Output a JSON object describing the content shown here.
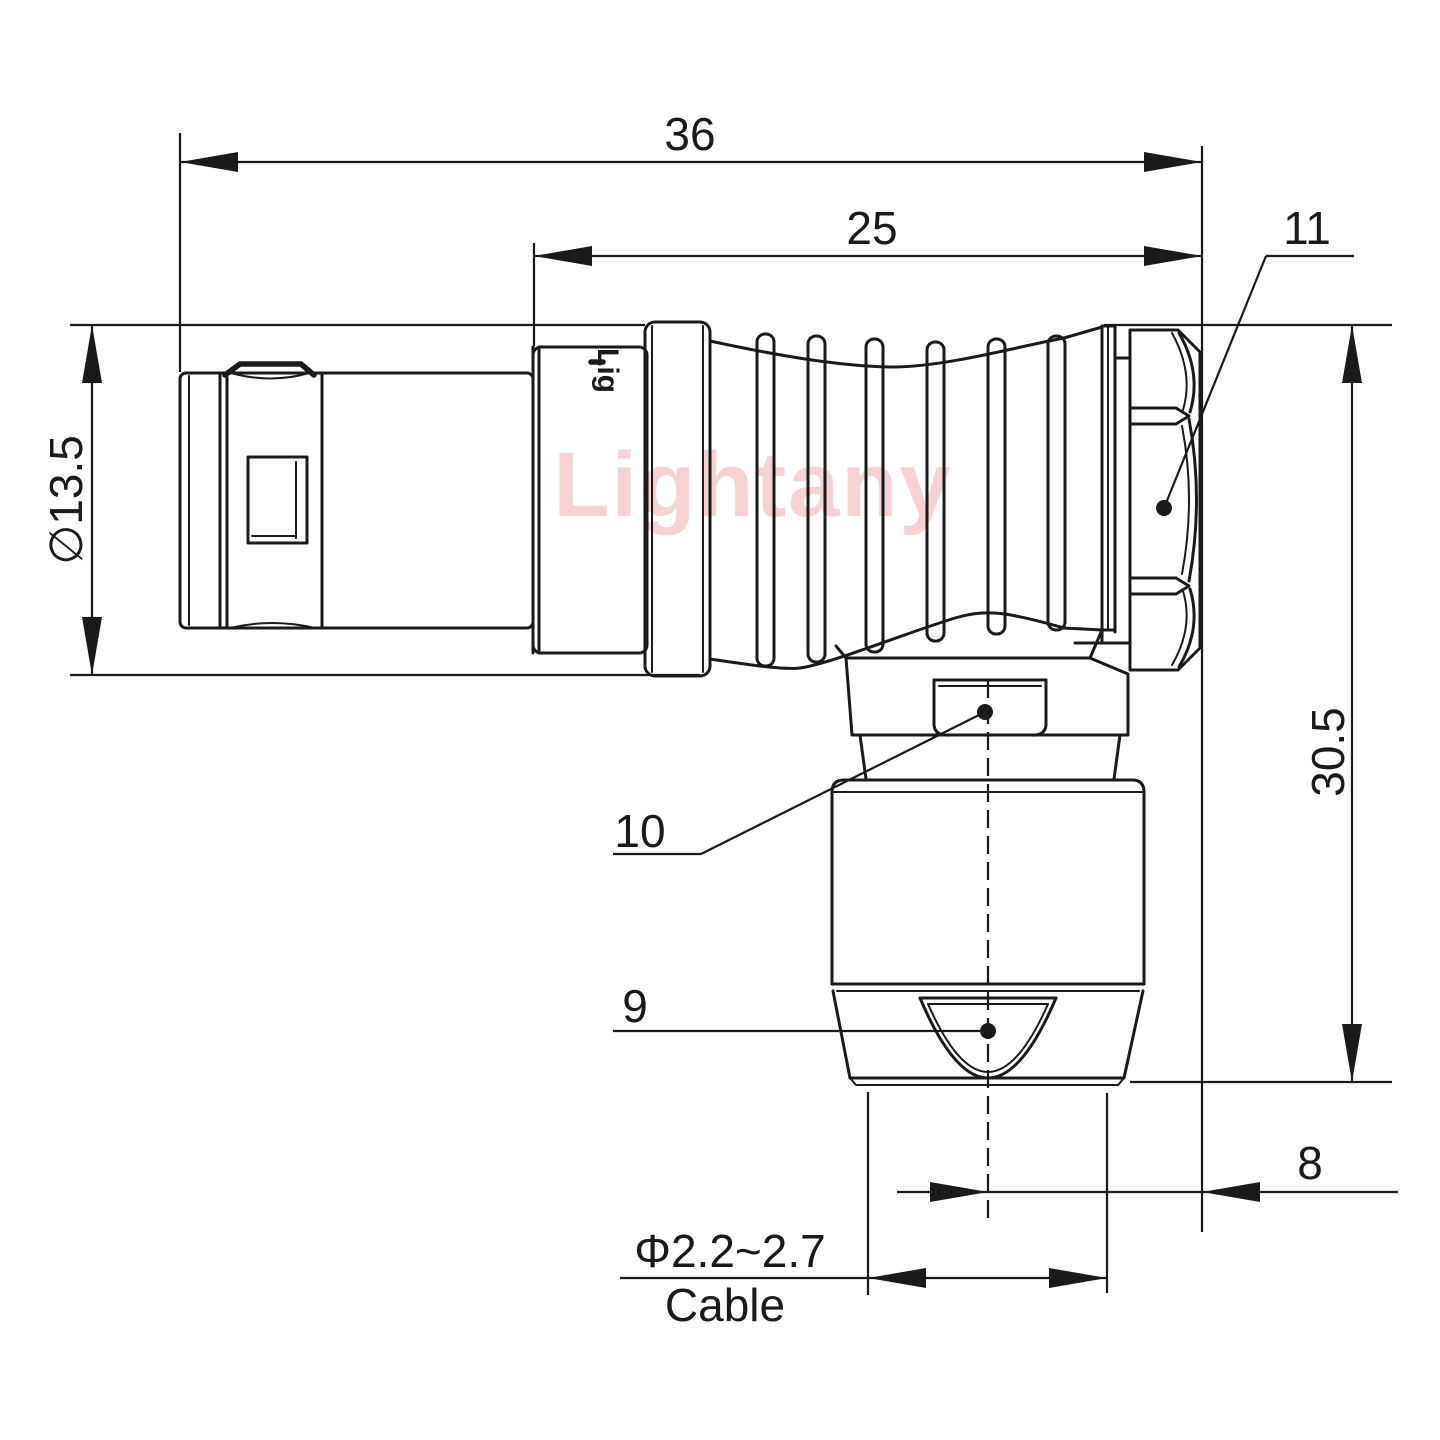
{
  "labels": {
    "dim_36": "36",
    "dim_25": "25",
    "callout_11": "11",
    "dim_diameter": "∅13.5",
    "dim_height": "30.5",
    "callout_10": "10",
    "callout_9": "9",
    "dim_8": "8",
    "cable_range": "Φ2.2~2.7",
    "cable_label": "Cable"
  },
  "watermark": "Lightany",
  "part_marking": "Lig",
  "colors": {
    "line": "#1a1a1a",
    "watermark": "#f6d2d2",
    "background": "#ffffff"
  }
}
